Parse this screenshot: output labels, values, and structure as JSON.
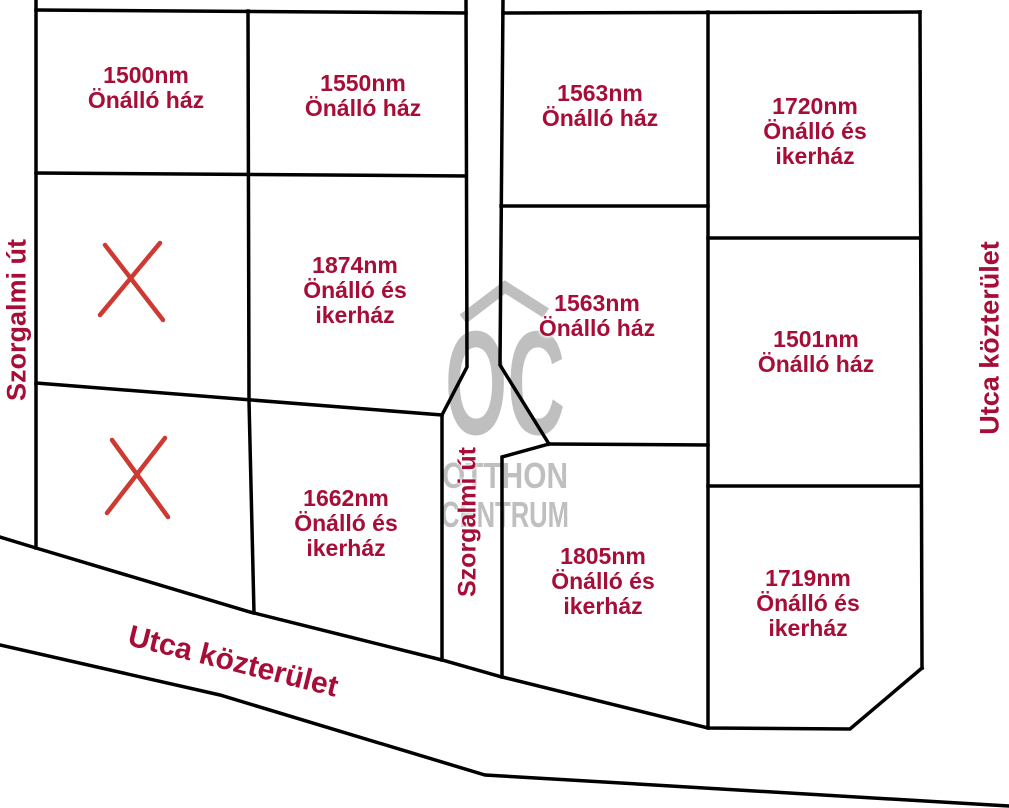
{
  "plots": [
    {
      "area": "1500nm",
      "type": "Önálló ház"
    },
    {
      "area": "1550nm",
      "type": "Önálló ház"
    },
    {
      "area": "1563nm",
      "type": "Önálló ház"
    },
    {
      "area": "1720nm",
      "type": "Önálló és ikerház"
    },
    {
      "area": "1874nm",
      "type": "Önálló és ikerház"
    },
    {
      "area": "1563nm",
      "type": "Önálló ház"
    },
    {
      "area": "1501nm",
      "type": "Önálló ház"
    },
    {
      "area": "1662nm",
      "type": "Önálló és ikerház"
    },
    {
      "area": "1805nm",
      "type": "Önálló és ikerház"
    },
    {
      "area": "1719nm",
      "type": "Önálló és ikerház"
    }
  ],
  "streets": {
    "left": "Szorgalmi út",
    "middle": "Szorgalmi út",
    "right": "Utca közterület",
    "bottom": "Utca közterület"
  },
  "watermark": {
    "logo": "OC",
    "name_line1": "OTTHON",
    "name_line2": "CENTRUM"
  },
  "colors": {
    "label": "#A60E38",
    "boundary_line": "#000000",
    "cross_mark": "#CD3A31",
    "watermark": "#BFBFBF"
  }
}
